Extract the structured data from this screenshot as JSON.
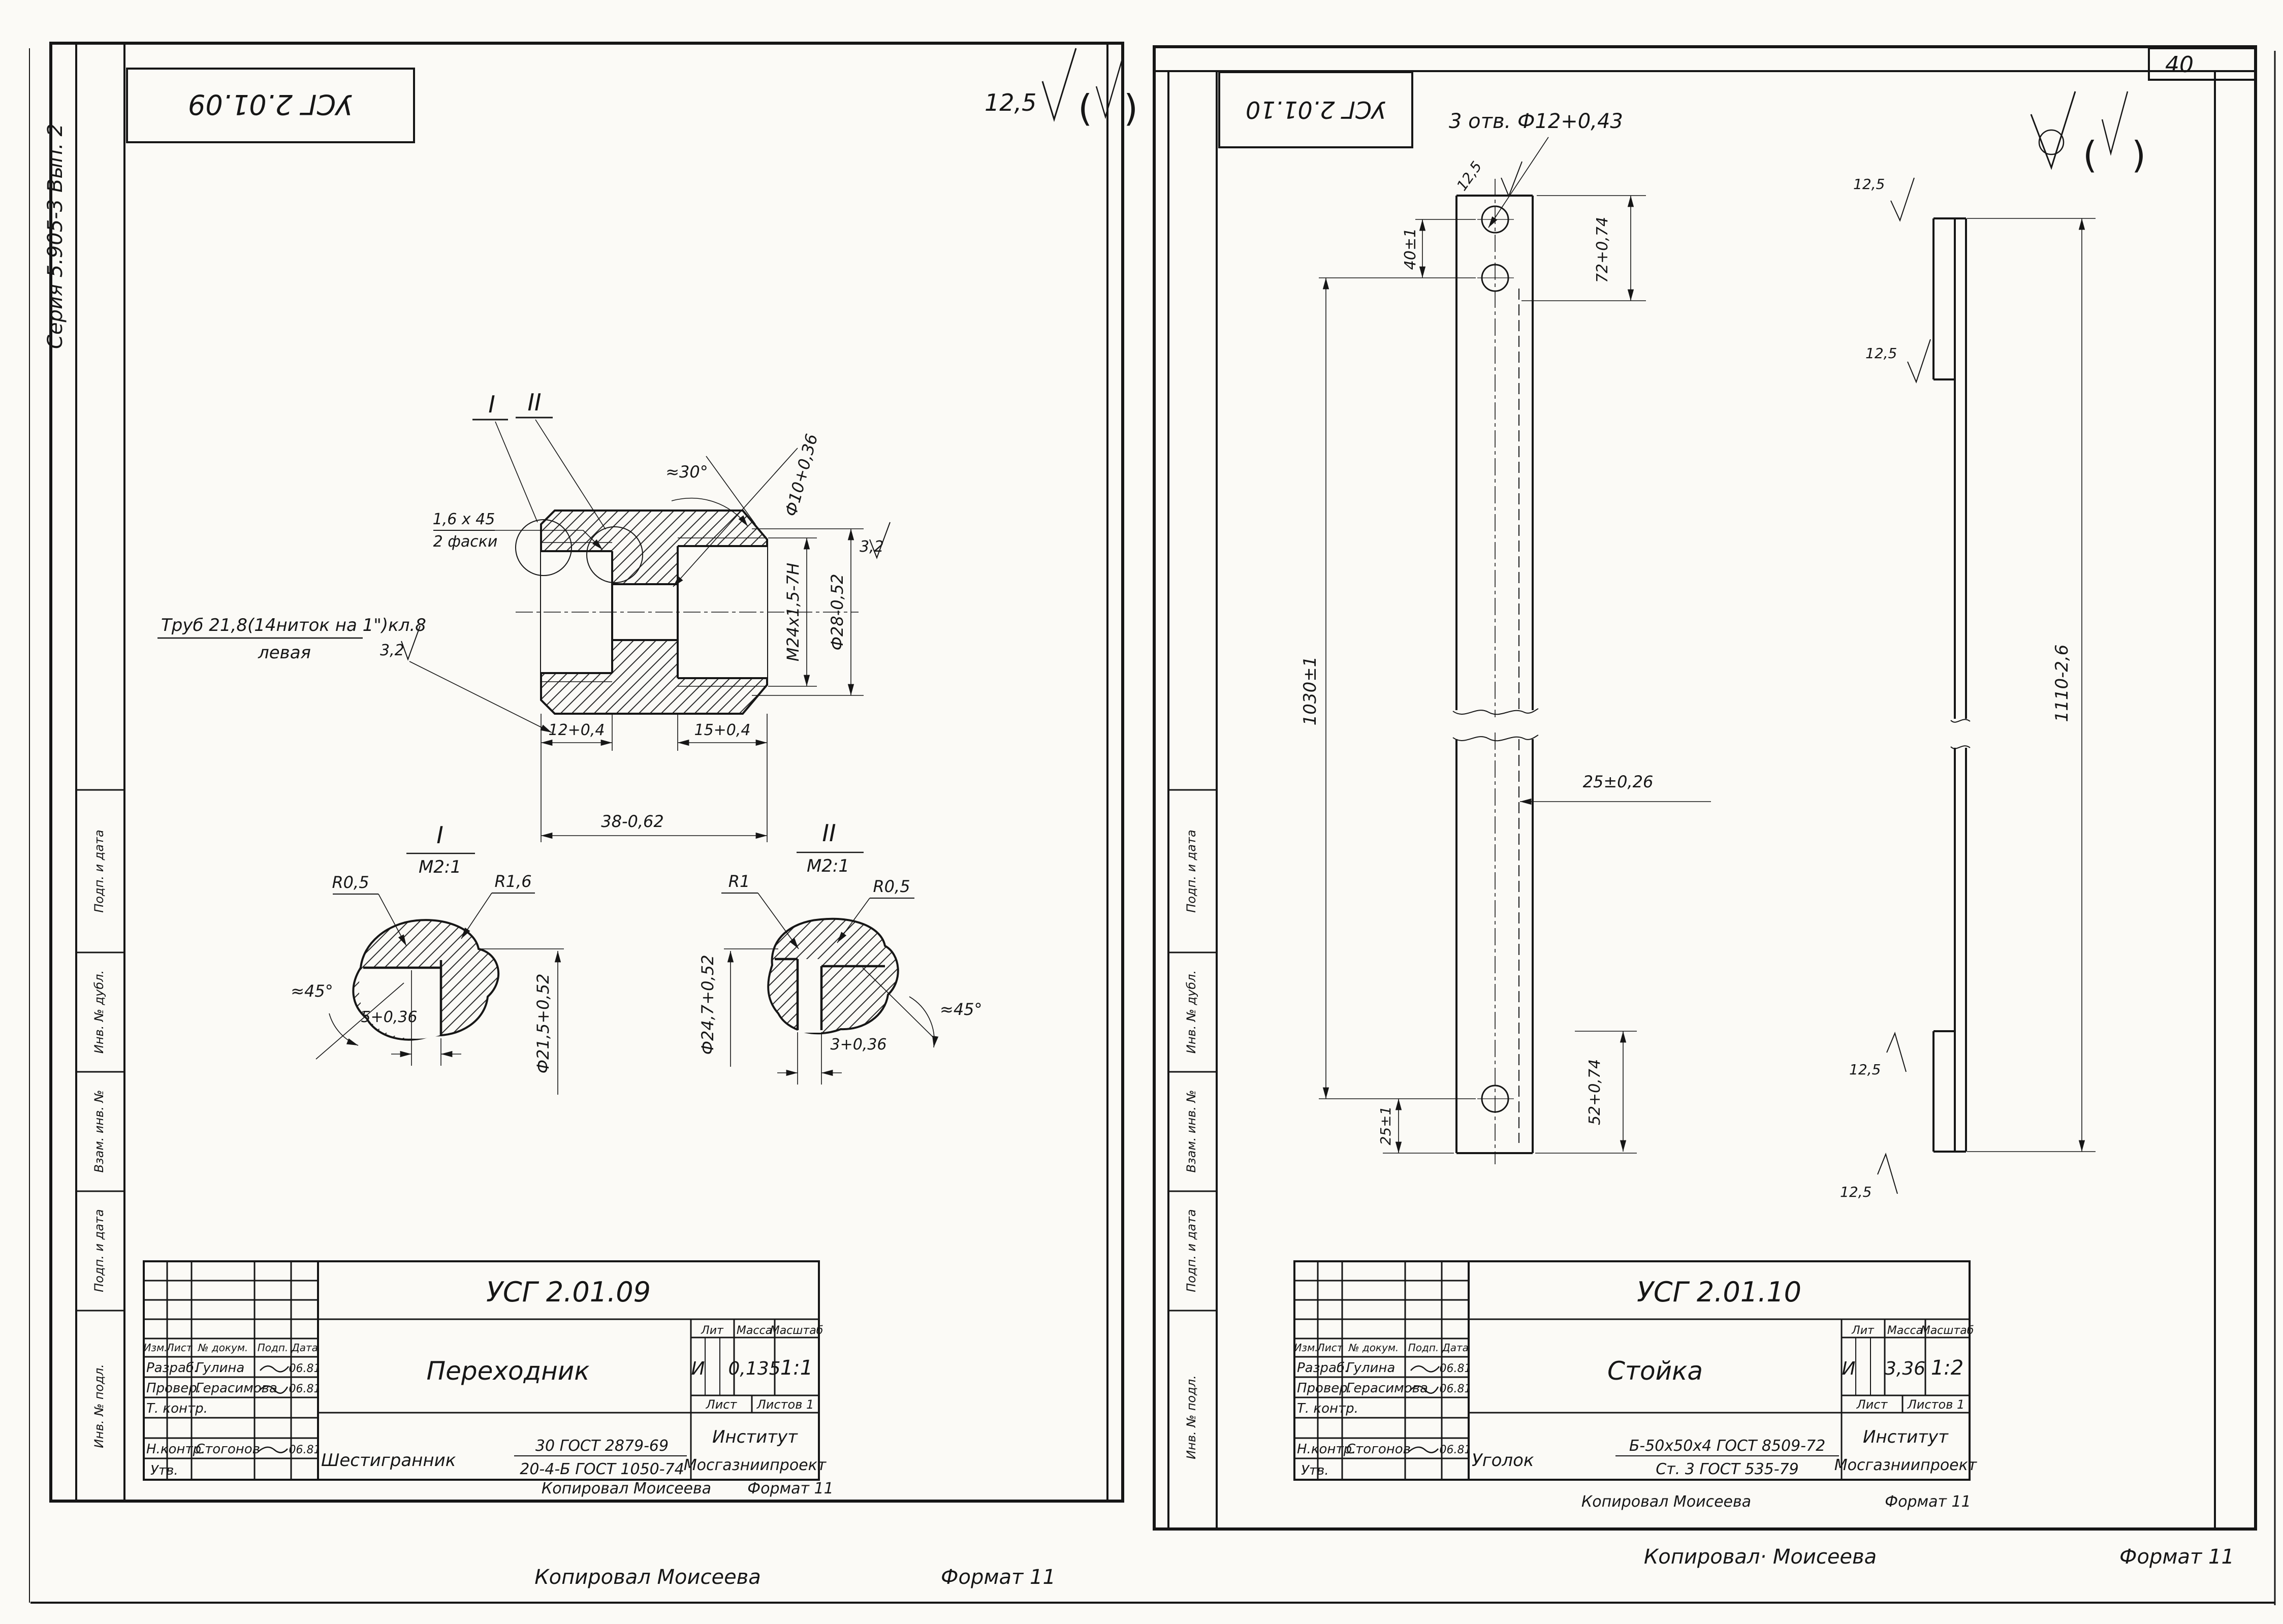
{
  "album": {
    "page_number": "40",
    "copy_left": "Копировал Моисеева",
    "format_left": "Формат 11",
    "copy_right": "Копировал· Моисеева",
    "format_right": "Формат 11"
  },
  "tb": {
    "h_izm": "Изм.",
    "h_list": "Лист",
    "h_doc": "№ докум.",
    "h_sign": "Подп.",
    "h_date": "Дата",
    "r1_label": "Разраб.",
    "r1_name": "Гулина",
    "r1_date": "06.81",
    "r2_label": "Провер.",
    "r2_name": "Герасимова",
    "r2_date": "06.81",
    "r3_label": "Т. контр.",
    "r4_label": "Н.контр.",
    "r4_name": "Стогонов",
    "r4_date": "06.81",
    "r5_label": "Утв.",
    "h_lit": "Лит",
    "h_mass": "Масса",
    "h_scale": "Масштаб",
    "sheet_label": "Лист",
    "sheets_label": "Листов 1"
  },
  "ls": {
    "code": "УСГ 2.01.09",
    "series": "Серия 5.905-3    Вып. 2",
    "rough_gen": "12,5",
    "margin": [
      "Подп. и дата",
      "Инв. № дубл.",
      "Взам. инв. №",
      "Подп. и дата",
      "Инв. № подл."
    ],
    "v": {
      "s1": "I",
      "s2": "II",
      "chamfer1": "1,6 х 45",
      "chamfer2": "2 фаски",
      "thread": "Труб 21,8(14ниток на 1\")кл.8",
      "thread2": "левая",
      "r32a": "3,2",
      "r32b": "3,2",
      "angle30": "≈30°",
      "dia10": "Ф10+0,36",
      "m24": "М24х1,5-7Н",
      "dia28": "Ф28-0,52",
      "d12": "12+0,4",
      "d15": "15+0,4",
      "d38": "38-0,62"
    },
    "d1": {
      "label": "I",
      "scale": "М2:1",
      "r1": "R0,5",
      "r2": "R1,6",
      "angle": "≈45°",
      "dim": "5+0,36",
      "dia": "Ф21,5+0,52"
    },
    "d2": {
      "label": "II",
      "scale": "М2:1",
      "r1": "R1",
      "r2": "R0,5",
      "angle": "≈45°",
      "dim": "3+0,36",
      "dia": "Ф24,7+0,52"
    },
    "tbx": {
      "code": "УСГ 2.01.09",
      "name": "Переходник",
      "lit": "И",
      "mass": "0,135",
      "scale": "1:1",
      "mat_prefix": "Шестигранник",
      "mat_top": "30 ГОСТ 2879-69",
      "mat_bot": "20-4-Б ГОСТ 1050-74",
      "org1": "Институт",
      "org2": "Мосгазниипроект"
    },
    "foot_copy": "Копировал Моисеева",
    "foot_fmt": "Формат 11"
  },
  "rs": {
    "code": "УСГ 2.01.10",
    "holes_note": "3 отв. Ф12+0,43",
    "r125": "12,5",
    "margin": [
      "Подп. и дата",
      "Инв. № дубл.",
      "Взам. инв. №",
      "Подп. и дата",
      "Инв. № подл."
    ],
    "dims": {
      "d40": "40±1",
      "d1030": "1030±1",
      "d25a": "25±1",
      "d25b": "25±0,26",
      "d72": "72+0,74",
      "d52": "52+0,74",
      "d1110": "1110-2,6"
    },
    "tbx": {
      "code": "УСГ 2.01.10",
      "name": "Стойка",
      "lit": "И",
      "mass": "3,36",
      "scale": "1:2",
      "mat_prefix": "Уголок",
      "mat_top": "Б-50х50х4 ГОСТ 8509-72",
      "mat_bot": "Ст. 3 ГОСТ 535-79",
      "org1": "Институт",
      "org2": "Мосгазниипроект"
    },
    "foot_copy": "Копировал Моисеева",
    "foot_fmt": "Формат 11"
  }
}
